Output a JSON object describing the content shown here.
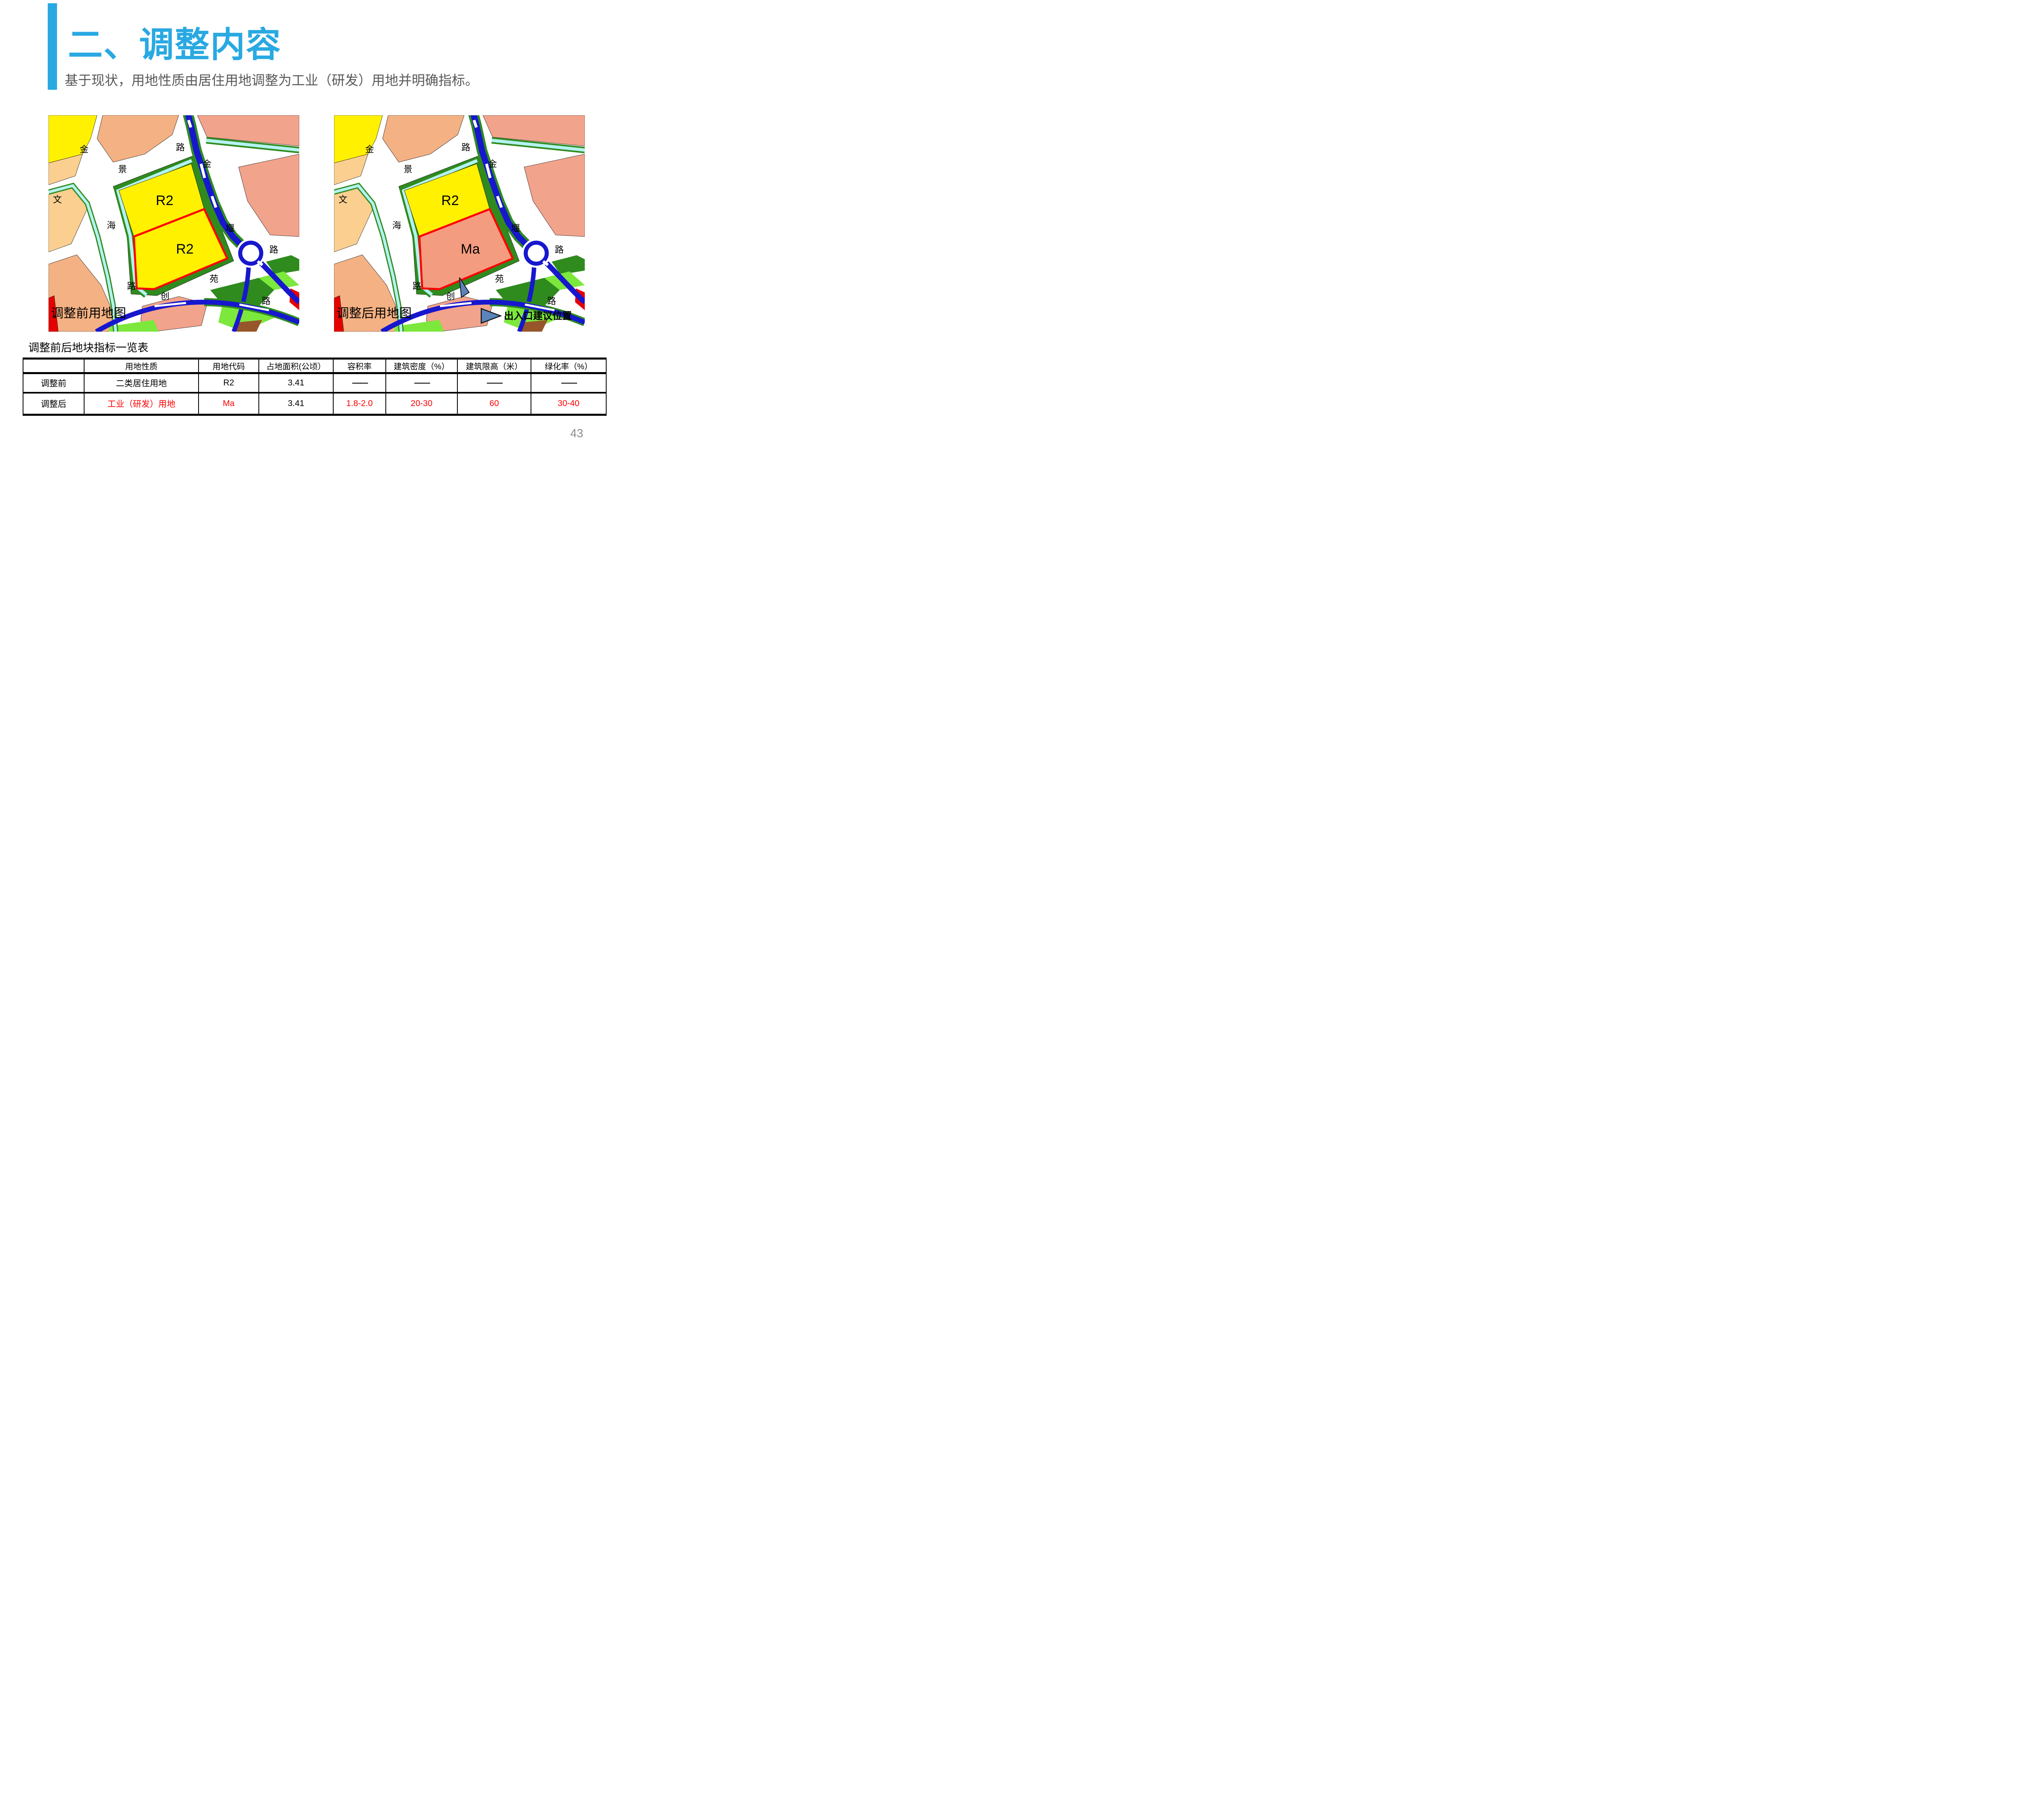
{
  "page": {
    "number": "43",
    "background": "#FFFFFF"
  },
  "header": {
    "accent_color": "#29A9E2",
    "title": "二、调整内容",
    "subtitle": "基于现状，用地性质由居住用地调整为工业（研发）用地并明确指标。"
  },
  "maps": {
    "upper_fill": "#FFF100",
    "road_labels": {
      "jin_nw": "金",
      "jing": "景",
      "lu_ne": "路",
      "jin_expwy": "金",
      "wen": "文",
      "hai": "海",
      "lu_sw": "路",
      "chuang": "创",
      "yuan": "苑",
      "lu_se": "路",
      "yan": "堰",
      "lu_e": "路"
    },
    "before": {
      "caption": "调整前用地图",
      "upper_label": "R2",
      "lower_label": "R2",
      "lower_fill": "#FFF100"
    },
    "after": {
      "caption": "调整后用地图",
      "upper_label": "R2",
      "lower_label": "Ma",
      "lower_fill": "#F49C80",
      "legend_label": "出入口建议位置"
    },
    "colors": {
      "residential_yellow": "#FFF100",
      "wheat": "#FBCF90",
      "peach": "#F4B183",
      "salmon": "#F2A38B",
      "industry_salmon": "#F49C80",
      "dark_green": "#2F8B1E",
      "bright_green": "#7CE83C",
      "canal_cyan": "#B5F2F0",
      "road_blue": "#1717CE",
      "parcel_red": "#E60000",
      "brown": "#96562A",
      "marker_blue": "#5B84BC",
      "plot_outline_red": "#FF0000"
    }
  },
  "table": {
    "title": "调整前后地块指标一览表",
    "highlight_color": "#FF0000",
    "headers": [
      "",
      "用地性质",
      "用地代码",
      "占地面积(公顷）",
      "容积率",
      "建筑密度（%）",
      "建筑限高（米）",
      "绿化率（%）"
    ],
    "rows": [
      {
        "label": "调整前",
        "cells": [
          "二类居住用地",
          "R2",
          "3.41",
          "——",
          "——",
          "——",
          "——"
        ]
      },
      {
        "label": "调整后",
        "cells": [
          "工业（研发）用地",
          "Ma",
          "3.41",
          "1.8-2.0",
          "20-30",
          "60",
          "30-40"
        ]
      }
    ]
  }
}
